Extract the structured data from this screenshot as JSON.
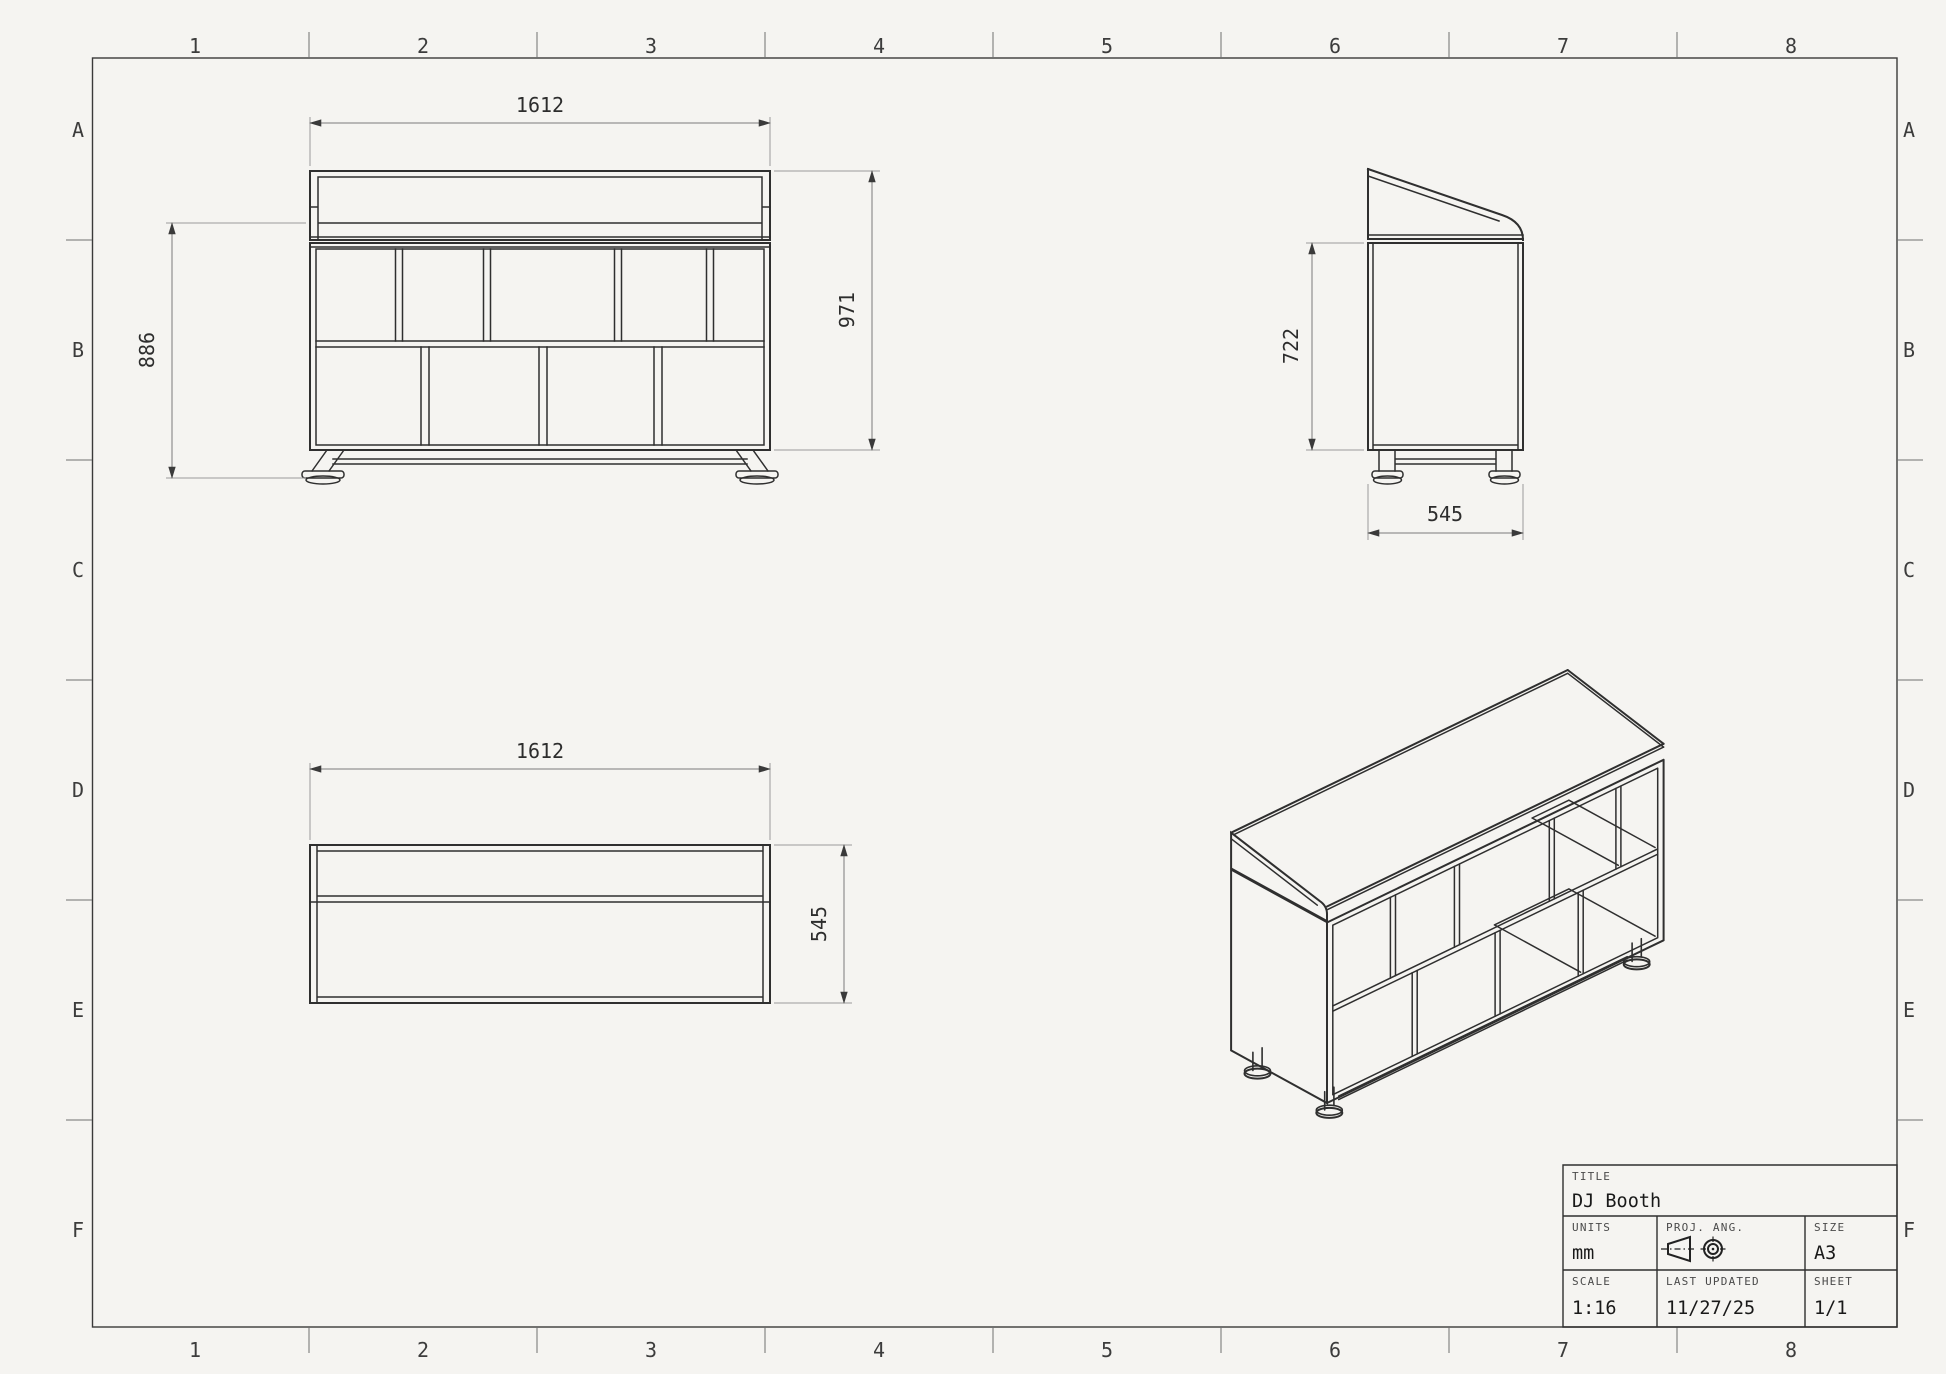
{
  "sheet": {
    "background_color": "#f5f4f1",
    "line_color": "#2f2f2f",
    "grid_columns": [
      "1",
      "2",
      "3",
      "4",
      "5",
      "6",
      "7",
      "8"
    ],
    "grid_rows": [
      "A",
      "B",
      "C",
      "D",
      "E",
      "F"
    ]
  },
  "views": {
    "front": {
      "dim_width": "1612",
      "dim_height_counter": "886",
      "dim_height_overall": "971"
    },
    "side": {
      "dim_height_body": "722",
      "dim_depth": "545"
    },
    "top": {
      "dim_width": "1612",
      "dim_depth": "545"
    }
  },
  "title_block": {
    "title_label": "TITLE",
    "title_value": "DJ Booth",
    "units_label": "UNITS",
    "units_value": "mm",
    "proj_label": "PROJ. ANG.",
    "size_label": "SIZE",
    "size_value": "A3",
    "scale_label": "SCALE",
    "scale_value": "1:16",
    "updated_label": "LAST UPDATED",
    "updated_value": "11/27/25",
    "sheet_label": "SHEET",
    "sheet_value": "1/1"
  },
  "model_mm": {
    "width": 1612,
    "depth": 545,
    "overall_height": 971,
    "counter_height": 886,
    "body_height": 722,
    "top_row_divider_fractions": [
      0.185,
      0.382,
      0.674,
      0.879
    ],
    "bottom_row_divider_fractions": [
      0.252,
      0.507,
      0.763
    ]
  }
}
